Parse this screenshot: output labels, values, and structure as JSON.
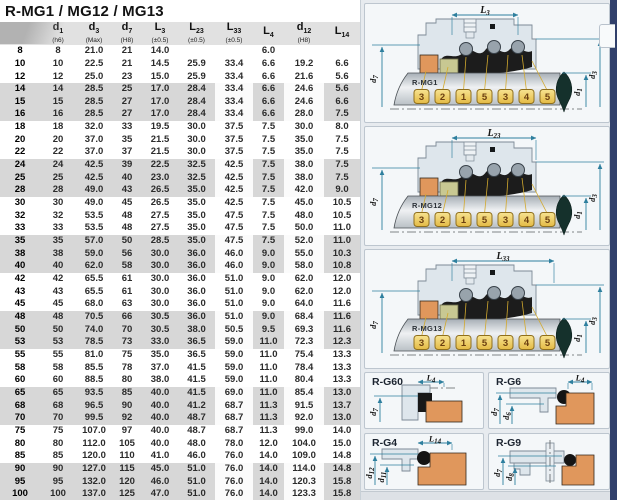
{
  "title": "R-MG1 / MG12 / MG13",
  "table": {
    "columns": [
      {
        "sym": "",
        "sub": "",
        "tol": ""
      },
      {
        "sym": "d",
        "sub": "1",
        "tol": "(h6)"
      },
      {
        "sym": "d",
        "sub": "3",
        "tol": "(Max)"
      },
      {
        "sym": "d",
        "sub": "7",
        "tol": "(H8)"
      },
      {
        "sym": "L",
        "sub": "3",
        "tol": "(±0.5)"
      },
      {
        "sym": "L",
        "sub": "23",
        "tol": "(±0.5)"
      },
      {
        "sym": "L",
        "sub": "33",
        "tol": "(±0.5)"
      },
      {
        "sym": "L",
        "sub": "4",
        "tol": ""
      },
      {
        "sym": "d",
        "sub": "12",
        "tol": "(H8)"
      },
      {
        "sym": "L",
        "sub": "14",
        "tol": ""
      }
    ],
    "rows": [
      [
        "8",
        "8",
        "21.0",
        "21",
        "14.0",
        "",
        "",
        "6.0",
        "",
        ""
      ],
      [
        "10",
        "10",
        "22.5",
        "21",
        "14.5",
        "25.9",
        "33.4",
        "6.6",
        "19.2",
        "6.6"
      ],
      [
        "12",
        "12",
        "25.0",
        "23",
        "15.0",
        "25.9",
        "33.4",
        "6.6",
        "21.6",
        "5.6"
      ],
      [
        "14",
        "14",
        "28.5",
        "25",
        "17.0",
        "28.4",
        "33.4",
        "6.6",
        "24.6",
        "5.6"
      ],
      [
        "15",
        "15",
        "28.5",
        "27",
        "17.0",
        "28.4",
        "33.4",
        "6.6",
        "24.6",
        "6.6"
      ],
      [
        "16",
        "16",
        "28.5",
        "27",
        "17.0",
        "28.4",
        "33.4",
        "6.6",
        "28.0",
        "7.5"
      ],
      [
        "18",
        "18",
        "32.0",
        "33",
        "19.5",
        "30.0",
        "37.5",
        "7.5",
        "30.0",
        "8.0"
      ],
      [
        "20",
        "20",
        "37.0",
        "35",
        "21.5",
        "30.0",
        "37.5",
        "7.5",
        "35.0",
        "7.5"
      ],
      [
        "22",
        "22",
        "37.0",
        "37",
        "21.5",
        "30.0",
        "37.5",
        "7.5",
        "35.0",
        "7.5"
      ],
      [
        "24",
        "24",
        "42.5",
        "39",
        "22.5",
        "32.5",
        "42.5",
        "7.5",
        "38.0",
        "7.5"
      ],
      [
        "25",
        "25",
        "42.5",
        "40",
        "23.0",
        "32.5",
        "42.5",
        "7.5",
        "38.0",
        "7.5"
      ],
      [
        "28",
        "28",
        "49.0",
        "43",
        "26.5",
        "35.0",
        "42.5",
        "7.5",
        "42.0",
        "9.0"
      ],
      [
        "30",
        "30",
        "49.0",
        "45",
        "26.5",
        "35.0",
        "42.5",
        "7.5",
        "45.0",
        "10.5"
      ],
      [
        "32",
        "32",
        "53.5",
        "48",
        "27.5",
        "35.0",
        "47.5",
        "7.5",
        "48.0",
        "10.5"
      ],
      [
        "33",
        "33",
        "53.5",
        "48",
        "27.5",
        "35.0",
        "47.5",
        "7.5",
        "50.0",
        "11.0"
      ],
      [
        "35",
        "35",
        "57.0",
        "50",
        "28.5",
        "35.0",
        "47.5",
        "7.5",
        "52.0",
        "11.0"
      ],
      [
        "38",
        "38",
        "59.0",
        "56",
        "30.0",
        "36.0",
        "46.0",
        "9.0",
        "55.0",
        "10.3"
      ],
      [
        "40",
        "40",
        "62.0",
        "58",
        "30.0",
        "36.0",
        "46.0",
        "9.0",
        "58.0",
        "10.8"
      ],
      [
        "42",
        "42",
        "65.5",
        "61",
        "30.0",
        "36.0",
        "51.0",
        "9.0",
        "62.0",
        "12.0"
      ],
      [
        "43",
        "43",
        "65.5",
        "61",
        "30.0",
        "36.0",
        "51.0",
        "9.0",
        "62.0",
        "12.0"
      ],
      [
        "45",
        "45",
        "68.0",
        "63",
        "30.0",
        "36.0",
        "51.0",
        "9.0",
        "64.0",
        "11.6"
      ],
      [
        "48",
        "48",
        "70.5",
        "66",
        "30.5",
        "36.0",
        "51.0",
        "9.0",
        "68.4",
        "11.6"
      ],
      [
        "50",
        "50",
        "74.0",
        "70",
        "30.5",
        "38.0",
        "50.5",
        "9.5",
        "69.3",
        "11.6"
      ],
      [
        "53",
        "53",
        "78.5",
        "73",
        "33.0",
        "36.5",
        "59.0",
        "11.0",
        "72.3",
        "12.3"
      ],
      [
        "55",
        "55",
        "81.0",
        "75",
        "35.0",
        "36.5",
        "59.0",
        "11.0",
        "75.4",
        "13.3"
      ],
      [
        "58",
        "58",
        "85.5",
        "78",
        "37.0",
        "41.5",
        "59.0",
        "11.0",
        "78.4",
        "13.3"
      ],
      [
        "60",
        "60",
        "88.5",
        "80",
        "38.0",
        "41.5",
        "59.0",
        "11.0",
        "80.4",
        "13.3"
      ],
      [
        "65",
        "65",
        "93.5",
        "85",
        "40.0",
        "41.5",
        "69.0",
        "11.0",
        "85.4",
        "13.0"
      ],
      [
        "68",
        "68",
        "96.5",
        "90",
        "40.0",
        "41.2",
        "68.7",
        "11.3",
        "91.5",
        "13.7"
      ],
      [
        "70",
        "70",
        "99.5",
        "92",
        "40.0",
        "48.7",
        "68.7",
        "11.3",
        "92.0",
        "13.0"
      ],
      [
        "75",
        "75",
        "107.0",
        "97",
        "40.0",
        "48.7",
        "68.7",
        "11.3",
        "99.0",
        "14.0"
      ],
      [
        "80",
        "80",
        "112.0",
        "105",
        "40.0",
        "48.0",
        "78.0",
        "12.0",
        "104.0",
        "15.0"
      ],
      [
        "85",
        "85",
        "120.0",
        "110",
        "41.0",
        "46.0",
        "76.0",
        "14.0",
        "109.0",
        "14.8"
      ],
      [
        "90",
        "90",
        "127.0",
        "115",
        "45.0",
        "51.0",
        "76.0",
        "14.0",
        "114.0",
        "14.8"
      ],
      [
        "95",
        "95",
        "132.0",
        "120",
        "46.0",
        "51.0",
        "76.0",
        "14.0",
        "120.3",
        "15.8"
      ],
      [
        "100",
        "100",
        "137.0",
        "125",
        "47.0",
        "51.0",
        "76.0",
        "14.0",
        "123.3",
        "15.8"
      ]
    ]
  },
  "diagrams": {
    "main": [
      {
        "label": "R-MG1",
        "top": {
          "sym": "L",
          "sub": "3"
        },
        "left": {
          "sym": "d",
          "sub": "7"
        },
        "right_inner": {
          "sym": "d",
          "sub": "1"
        },
        "right_outer": {
          "sym": "d",
          "sub": "3"
        },
        "numbers": [
          "3",
          "2",
          "1",
          "5",
          "3",
          "4",
          "5"
        ]
      },
      {
        "label": "R-MG12",
        "top": {
          "sym": "L",
          "sub": "23"
        },
        "left": {
          "sym": "d",
          "sub": "7"
        },
        "right_inner": {
          "sym": "d",
          "sub": "1"
        },
        "right_outer": {
          "sym": "d",
          "sub": "3"
        },
        "numbers": [
          "3",
          "2",
          "1",
          "5",
          "3",
          "4",
          "5"
        ]
      },
      {
        "label": "R-MG13",
        "top": {
          "sym": "L",
          "sub": "33"
        },
        "left": {
          "sym": "d",
          "sub": "7"
        },
        "right_inner": {
          "sym": "d",
          "sub": "1"
        },
        "right_outer": {
          "sym": "d",
          "sub": "3"
        },
        "numbers": [
          "3",
          "2",
          "1",
          "5",
          "3",
          "4",
          "5"
        ]
      }
    ],
    "small": [
      {
        "label": "R-G60",
        "top": {
          "sym": "L",
          "sub": "4"
        },
        "left": [
          {
            "sym": "d",
            "sub": "7"
          }
        ]
      },
      {
        "label": "R-G6",
        "top": {
          "sym": "L",
          "sub": "4"
        },
        "left": [
          {
            "sym": "d",
            "sub": "7"
          },
          {
            "sym": "d",
            "sub": "6"
          }
        ]
      },
      {
        "label": "R-G4",
        "top": {
          "sym": "L",
          "sub": "14"
        },
        "left": [
          {
            "sym": "d",
            "sub": "12"
          },
          {
            "sym": "d",
            "sub": "11"
          }
        ]
      },
      {
        "label": "R-G9",
        "left": [
          {
            "sym": "d",
            "sub": "7"
          },
          {
            "sym": "d",
            "sub": "8"
          }
        ]
      }
    ]
  },
  "colors": {
    "dimension_accent": "#2e7f9e",
    "navy_border": "#31406b",
    "row_band": "#d7d7d7",
    "gold_box": "#eecb55",
    "orange_ring": "#e0975c"
  }
}
